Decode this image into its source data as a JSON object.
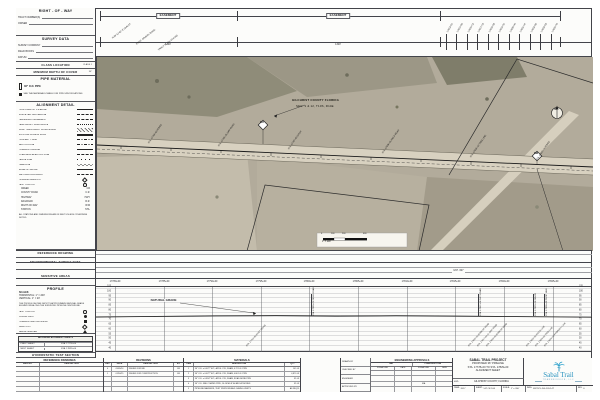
{
  "colors": {
    "accent_blue": "#2792be",
    "paper": "#fcfcfa",
    "ink": "#43444a",
    "map_base": "#b2ab9b",
    "corridor": "#d8d1c0"
  },
  "sidebar": {
    "right_of_way": {
      "title": "RIGHT - OF - WAY",
      "fields": [
        "TRACT NUMBER(S)",
        "OWNER"
      ]
    },
    "survey_data": {
      "title": "SURVEY DATA",
      "fields": [
        "SURVEY COMPANY",
        "FIELD BOOKS",
        "DATUM"
      ]
    },
    "class_location": {
      "title": "CLASS LOCATION",
      "value": "CLASS 1"
    },
    "min_depth": {
      "title": "MINIMUM DEPTH OF COVER",
      "value": "36\""
    },
    "pipe_material": {
      "title": "PIPE MATERIAL",
      "pipe": "36\" O.D. PIPE",
      "note": "SEE THE MATERIALS TABLE FOR PIPE SPECIFICATIONS"
    },
    "alignment_detail": {
      "title": "ALIGNMENT DETAIL",
      "items": [
        {
          "label": "PROPOSED 36\" PIPELINE",
          "sym": "solid"
        },
        {
          "label": "SURVEYED CENTERLINE",
          "sym": "dashed"
        },
        {
          "label": "PERMANENT EASEMENT",
          "sym": "dashed"
        },
        {
          "label": "TEMPORARY WORKSPACE",
          "sym": "dotted"
        },
        {
          "label": "ADDL. TEMPORARY WORKSPACE",
          "sym": "hatch"
        },
        {
          "label": "EXISTING ACCESS ROAD",
          "sym": "double"
        },
        {
          "label": "PROPERTY LINE",
          "sym": "dashdot"
        },
        {
          "label": "SECTION L​INE",
          "sym": "dashdot"
        },
        {
          "label": "FOREIGN PIPELINE",
          "sym": "solid"
        },
        {
          "label": "OVERHEAD ELECTRIC LINE",
          "sym": "dashed"
        },
        {
          "label": "FENCE LINE",
          "sym": "xline"
        },
        {
          "label": "TREE LINE",
          "sym": "scallop"
        },
        {
          "label": "EDGE OF WATER",
          "sym": "solid"
        },
        {
          "label": "WETLAND BOUNDARY",
          "sym": "dashed"
        },
        {
          "label": "PIPELINE MILEPOST",
          "sym": "diamond"
        },
        {
          "label": "TEST STATION",
          "sym": "circle"
        }
      ],
      "abbrs": [
        [
          "CREEK",
          "CR"
        ],
        [
          "COUNTY ROAD",
          "C.R."
        ],
        [
          "HIGHWAY",
          "HWY"
        ],
        [
          "RAILROAD",
          "R.R."
        ],
        [
          "RIGHT-OF-WAY",
          "R/W"
        ],
        [
          "STATION",
          "STA."
        ]
      ],
      "note": "ALL STATIONS AND DIMENSIONS ARE IN FEET UNLESS OTHERWISE NOTED."
    },
    "reference_drawing": {
      "title": "REFERENCE DRAWING"
    },
    "environmental": {
      "title": "ENVIRONMENTAL SURVEY DATA"
    },
    "sensitive": {
      "title": "SENSITIVE AREAS"
    },
    "profile_panel": {
      "title": "PROFILE",
      "scales_label": "SCALES:",
      "scale_h": "HORIZONTAL: 1\" = 200'",
      "scale_v": "VERTICAL: 1\" = 20'",
      "note": "THE PROFILE SHOWN DEPICTS APPROXIMATE NATURAL GRADE ELEVATIONS ALONG THE SURVEYED PIPELINE CENTERLINE.",
      "items": [
        {
          "label": "TEST STATION",
          "sym": "circle"
        },
        {
          "label": "CASING VENT",
          "sym": "dot"
        },
        {
          "label": "FOREIGN LINE CROSSING",
          "sym": "square"
        },
        {
          "label": "MILE POST",
          "sym": "diamond"
        },
        {
          "label": "AERIAL MARKER",
          "sym": "triangle"
        }
      ]
    },
    "adjoining": {
      "title": "ADJOINING ALIGNMENT SHEETS",
      "rows": [
        [
          "PREV. SHEET",
          "STA. 17778+00"
        ],
        [
          "NEXT SHEET",
          "STA. 17829+00"
        ]
      ]
    },
    "hydro_title": "HYDROSTATIC TEST SECTION"
  },
  "top_strip": {
    "segments": [
      {
        "label": "EASEMENT",
        "dim": "1320'",
        "x": 168
      },
      {
        "label": "EASEMENT",
        "dim": "1320'",
        "x": 338
      }
    ],
    "stations": [
      {
        "text": "17813+91",
        "x": 446
      },
      {
        "text": "17814+99",
        "x": 456
      },
      {
        "text": "17816+12",
        "x": 467
      },
      {
        "text": "17817+15",
        "x": 477
      },
      {
        "text": "17818+28",
        "x": 488
      },
      {
        "text": "17819+31",
        "x": 498
      },
      {
        "text": "17820+44",
        "x": 509
      },
      {
        "text": "17821+47",
        "x": 519
      },
      {
        "text": "17822+60",
        "x": 530
      },
      {
        "text": "17823+63",
        "x": 540
      },
      {
        "text": "17824+76",
        "x": 551
      }
    ],
    "bearings": [
      {
        "text": "N 89°12'40\" E  2640.87'",
        "x": 112,
        "y": 38
      },
      {
        "text": "EXIST. GRAVEL ROAD",
        "x": 136,
        "y": 44
      },
      {
        "text": "TRACT FL-GIL-024.000",
        "x": 158,
        "y": 50
      }
    ]
  },
  "map": {
    "county_line1": "GILCHRIST COUNTY FLORIDA",
    "county_line2": "SEC. 1 & 12, T10S, R14E",
    "mp1": "337",
    "mp2": "338",
    "north": "N",
    "scale_ticks": [
      {
        "t": "0",
        "x": 321
      },
      {
        "t": "100",
        "x": 331
      },
      {
        "t": "200",
        "x": 342
      },
      {
        "t": "400",
        "x": 363
      }
    ],
    "scale_caption": "1\" = 200'",
    "callouts": [
      {
        "text": "STA. 17784+60 FENCE",
        "x": 148,
        "y": 143
      },
      {
        "text": "STA. 17791+25 DIRT ROAD",
        "x": 218,
        "y": 146
      },
      {
        "text": "STA. 17797+80 DITCH",
        "x": 288,
        "y": 149
      },
      {
        "text": "STA. 17806+45 FIELD ROAD",
        "x": 382,
        "y": 153
      },
      {
        "text": "STA. 17815+10 TREE LINE",
        "x": 470,
        "y": 157
      },
      {
        "text": "STA. 17822+74 FENCE",
        "x": 536,
        "y": 160
      }
    ]
  },
  "bands": {
    "mp_label": "M.P. 337"
  },
  "profile": {
    "natural_grade_label": "NATURAL GRADE",
    "stations": [
      {
        "label": "17780+00",
        "x": 115
      },
      {
        "label": "17785+00",
        "x": 164
      },
      {
        "label": "17790+00",
        "x": 212
      },
      {
        "label": "17795+00",
        "x": 261
      },
      {
        "label": "17800+00",
        "x": 309
      },
      {
        "label": "17805+00",
        "x": 358
      },
      {
        "label": "17810+00",
        "x": 407
      },
      {
        "label": "17815+00",
        "x": 455
      },
      {
        "label": "17820+00",
        "x": 504
      },
      {
        "label": "17825+00",
        "x": 553
      }
    ],
    "elevations": [
      {
        "t": "105",
        "y": 287
      },
      {
        "t": "100",
        "y": 292
      },
      {
        "t": "95",
        "y": 297
      },
      {
        "t": "90",
        "y": 301
      },
      {
        "t": "85",
        "y": 306
      },
      {
        "t": "80",
        "y": 311
      },
      {
        "t": "75",
        "y": 316
      },
      {
        "t": "70",
        "y": 320
      },
      {
        "t": "65",
        "y": 325
      },
      {
        "t": "60",
        "y": 330
      },
      {
        "t": "55",
        "y": 335
      },
      {
        "t": "50",
        "y": 339
      },
      {
        "t": "45",
        "y": 344
      },
      {
        "t": "40",
        "y": 349
      }
    ],
    "callouts": [
      {
        "text": "STA. 17800+21 FIELD ROAD",
        "x": 311
      },
      {
        "text": "STA. 17817+64 DIRT ROAD",
        "x": 478
      },
      {
        "text": "STA. 17823+30 FENCE",
        "x": 533
      },
      {
        "text": "STA. 17824+40 PROP. LINE",
        "x": 544
      }
    ],
    "diag_notes": [
      {
        "text": "STA. 17792+80 EXIST. FENCE",
        "x": 246
      },
      {
        "text": "STA. 17816+90 EDGE OF ROAD",
        "x": 468
      },
      {
        "text": "STA. 17817+64 CL DIRT ROAD",
        "x": 477
      },
      {
        "text": "STA. 17818+40 EDGE OF ROAD",
        "x": 486
      },
      {
        "text": "STA. 17823+30 FENCE LINE",
        "x": 526
      },
      {
        "text": "STA. 17824+00 TREE LINE",
        "x": 535
      },
      {
        "text": "STA. 17824+70 PROPERTY LINE",
        "x": 544
      }
    ]
  },
  "tables": {
    "ref_drawings": {
      "title": "REFERENCE DRAWINGS",
      "col1": "DWG NO.",
      "col2": "DESCRIPTION"
    },
    "revisions": {
      "title": "REVISIONS",
      "cols": [
        "REV",
        "DATE",
        "DESCRIPTION",
        "BY"
      ],
      "rows": [
        [
          "0",
          "09/05/14",
          "ISSUED FOR BID",
          "JM"
        ],
        [
          "1",
          "01/16/15",
          "ISSUED FOR CONSTRUCTION",
          "JM"
        ]
      ]
    },
    "materials": {
      "title": "MATERIALS",
      "cols": [
        "ITEM",
        "DESCRIPTION",
        "QTY"
      ],
      "rows": [
        [
          "1",
          "36\" O.D. x 0.672\" W.T., API-5L X70, DSAW, 0.72 D.F. PIPE",
          "145 LF"
        ],
        [
          "2",
          "36\" O.D. x 0.672\" W.T., API-5L X70, DSAW, 0.80 D.F. PIPE",
          "4,870 LF"
        ],
        [
          "3",
          "36\" O.D. x 0.834\" W.T., API-5L X70, DSAW, ROAD BORE PIPE",
          "85 LF"
        ],
        [
          "4",
          "36\" O.D. FBE COATED PIPE, 14-16 MILS W/ ARO AT BORES",
          "85 LF"
        ],
        [
          "5",
          "PIPELINE MARKERS, TEST STATIONS AND CASING VENTS",
          "AS REQ'D"
        ]
      ]
    },
    "approvals": {
      "title": "ENGINEERING APPROVALS",
      "groups": [
        "BID",
        "CONSTRUCTION"
      ],
      "sub": [
        "SIGNATURE",
        "DATE",
        "SIGNATURE",
        "DATE"
      ],
      "rows": [
        "DRAWN BY",
        "CHECKED BY",
        "ENGINEER",
        "APPROVED BY"
      ],
      "na": "N/A"
    }
  },
  "title_block": {
    "project": "SABAL TRAIL PROJECT",
    "line2": "PROPOSED 36\" PIPELINE",
    "line3": "STA. 17778+00 TO STA. 17829+00",
    "line4": "ALIGNMENT SHEET",
    "loc_label": "LOC:",
    "loc": "GILCHRIST COUNTY, FLORIDA",
    "year_label": "YEAR:",
    "year": "2017",
    "sheet_label": "SHEET:",
    "sheet": "147 OF 166",
    "scale_label": "SCALE:",
    "scale": "1\" = 200'",
    "dwg_label": "DWG:",
    "dwg": "SWT-PL-DG-101-147",
    "rev_label": "REV:",
    "rev": "0",
    "logo_name": "Sabal Trail",
    "logo_sub": "TRANSMISSION, LLC"
  }
}
